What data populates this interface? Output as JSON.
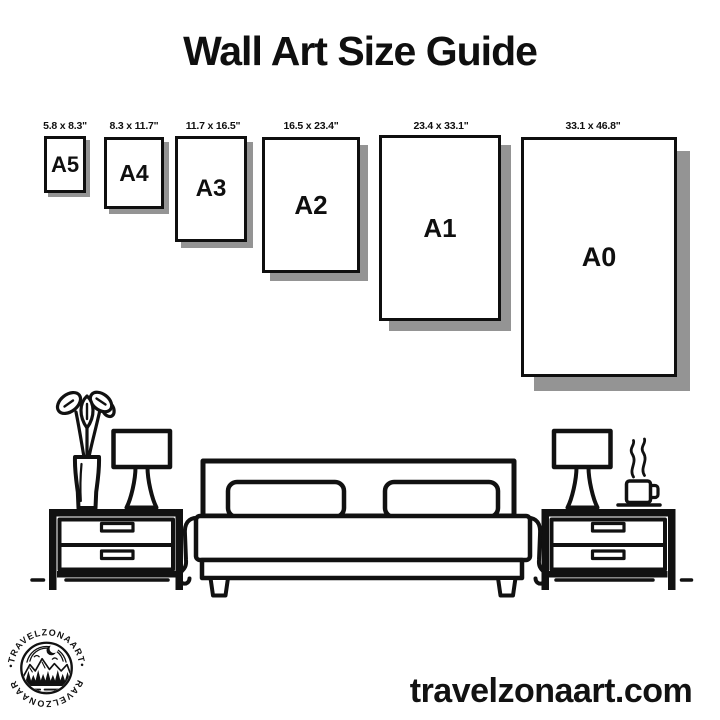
{
  "title": "Wall Art Size Guide",
  "sizes": [
    {
      "code": "A5",
      "dimensions": "5.8 x 8.3\""
    },
    {
      "code": "A4",
      "dimensions": "8.3 x 11.7\""
    },
    {
      "code": "A3",
      "dimensions": "11.7 x 16.5\""
    },
    {
      "code": "A2",
      "dimensions": "16.5 x 23.4\""
    },
    {
      "code": "A1",
      "dimensions": "23.4 x 33.1\""
    },
    {
      "code": "A0",
      "dimensions": "33.1 x 46.8\""
    }
  ],
  "illustration": {
    "items": [
      "potted-plant",
      "table-lamp",
      "nightstand",
      "double-bed",
      "coffee-cup"
    ]
  },
  "logo": {
    "brand": "TRAVELZONAART",
    "ring_text_top": "•TRAVELZONAART•",
    "ring_text_bottom": "•TRAVELZONAART•"
  },
  "footer": {
    "website": "travelzonaart.com"
  },
  "colors": {
    "ink": "#111111",
    "shadow": "#949494",
    "background": "#ffffff"
  }
}
